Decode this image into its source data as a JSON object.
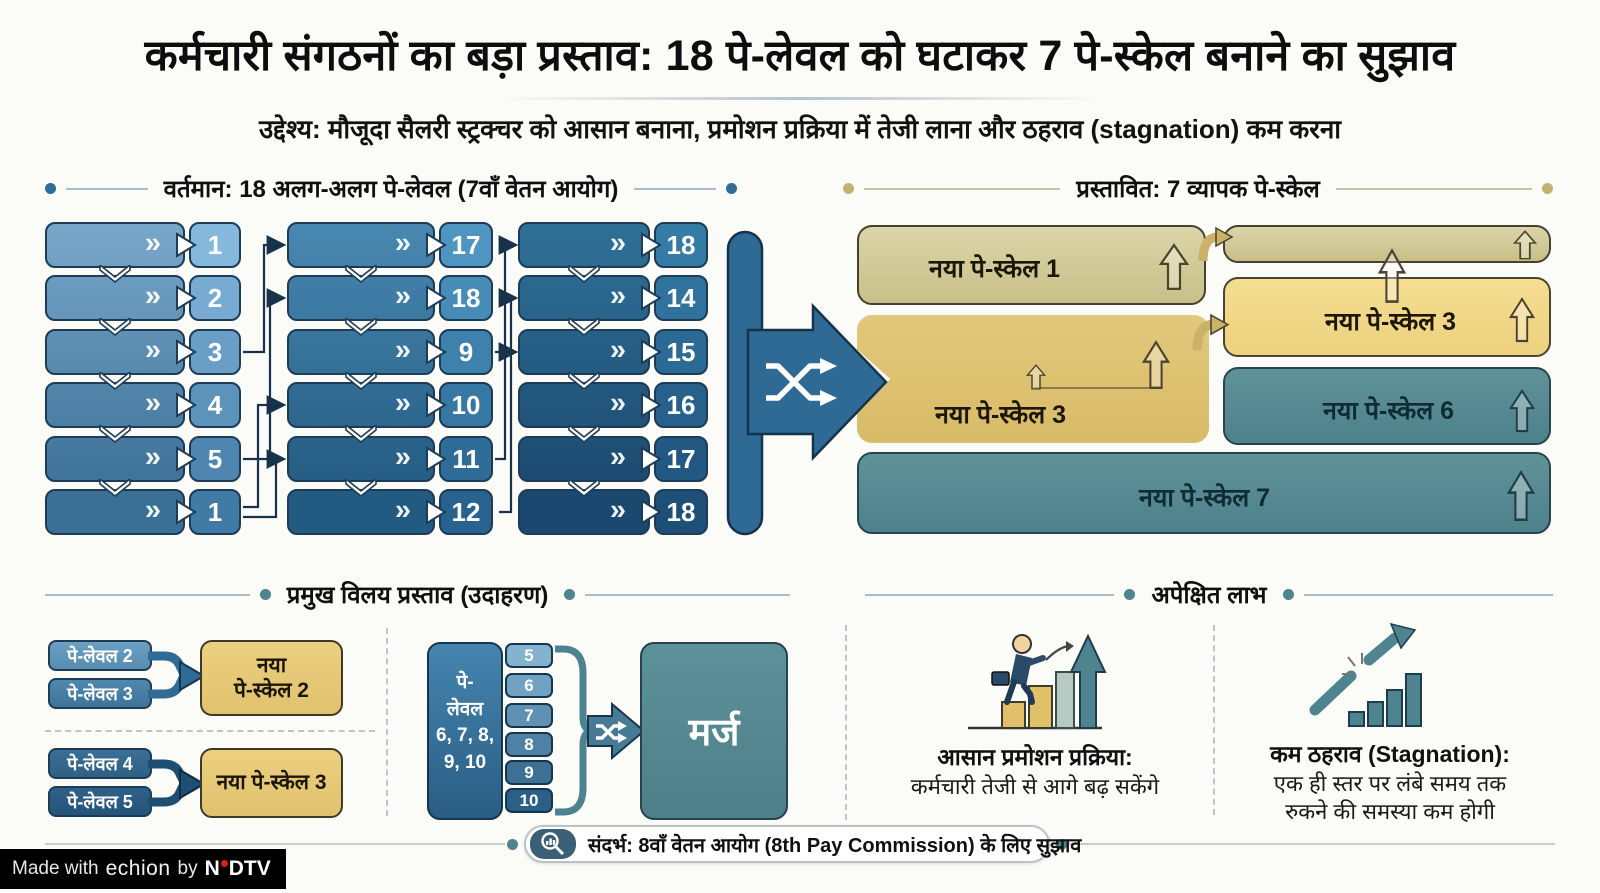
{
  "title": "कर्मचारी संगठनों का बड़ा प्रस्ताव: 18 पे-लेवल को घटाकर 7 पे-स्केल बनाने का सुझाव",
  "subtitle": "उद्देश्य: मौजूदा सैलरी स्ट्रक्चर को आसान बनाना, प्रमोशन प्रक्रिया में तेजी लाना और ठहराव (stagnation) कम करना",
  "current": {
    "header": "वर्तमान: 18 अलग-अलग पे-लेवल (7वाँ वेतन आयोग)",
    "columns": [
      [
        "1",
        "2",
        "3",
        "4",
        "5",
        "1"
      ],
      [
        "17",
        "18",
        "9",
        "10",
        "11",
        "12"
      ],
      [
        "18",
        "14",
        "15",
        "16",
        "17",
        "18"
      ]
    ]
  },
  "proposed": {
    "header": "प्रस्तावित: 7 व्यापक पे-स्केल",
    "boxes": [
      {
        "label": "नया पे-स्केल 1"
      },
      {
        "label": ""
      },
      {
        "label": "नया पे-स्केल 3"
      },
      {
        "label": "नया पे-स्केल 3"
      },
      {
        "label": "नया पे-स्केल 6"
      },
      {
        "label": "नया पे-स्केल 7"
      }
    ]
  },
  "merge_examples": {
    "header": "प्रमुख विलय प्रस्ताव (उदाहरण)",
    "example1": {
      "inputs": [
        "पे-लेवल 2",
        "पे-लेवल 3"
      ],
      "output_line1": "नया",
      "output_line2": "पे-स्केल 2"
    },
    "example2": {
      "inputs": [
        "पे-लेवल 4",
        "पे-लेवल 5"
      ],
      "output": "नया पे-स्केल 3"
    },
    "example3": {
      "source_lines": [
        "पे-",
        "लेवल",
        "6, 7, 8,",
        "9, 10"
      ],
      "levels": [
        "5",
        "6",
        "7",
        "8",
        "9",
        "10"
      ],
      "output": "मर्ज"
    }
  },
  "benefits": {
    "header": "अपेक्षित लाभ",
    "items": [
      {
        "title": "आसान प्रमोशन प्रक्रिया:",
        "desc": "कर्मचारी तेजी से आगे बढ़ सकेंगे"
      },
      {
        "title": "कम ठहराव (Stagnation):",
        "desc_line1": "एक ही स्तर पर लंबे समय तक",
        "desc_line2": "रुकने की समस्या कम होगी"
      }
    ]
  },
  "footer": {
    "reference": "संदर्भ: 8वाँ वेतन आयोग (8th Pay Commission) के लिए सुझाव",
    "credit_prefix": "Made with",
    "credit_brand": "echion",
    "credit_by": "by",
    "credit_org_n": "N",
    "credit_org_rest": "DTV"
  },
  "colors": {
    "grid_col1": [
      "#79a7c9",
      "#3a6f96"
    ],
    "grid_col2": [
      "#4887b0",
      "#235a81"
    ],
    "grid_col3": [
      "#2f7097",
      "#1b486e"
    ],
    "tab_range": [
      "#84b3d0",
      "#2b5f86"
    ],
    "funnel": "#2e6a93",
    "funnel_outline": "#16334c",
    "khaki": "#d2cb95",
    "yellow": "#f2d98a",
    "gold": "#ddc070",
    "teal": "#578a92",
    "chip1": "#5e93b8",
    "chip2": "#447aa2",
    "chip3": "#33678f",
    "chip4": "#2a5a80",
    "accent_navy": "#1d3c57",
    "dot_teal": "#2e6d96",
    "dot_khaki": "#c3b26e"
  }
}
